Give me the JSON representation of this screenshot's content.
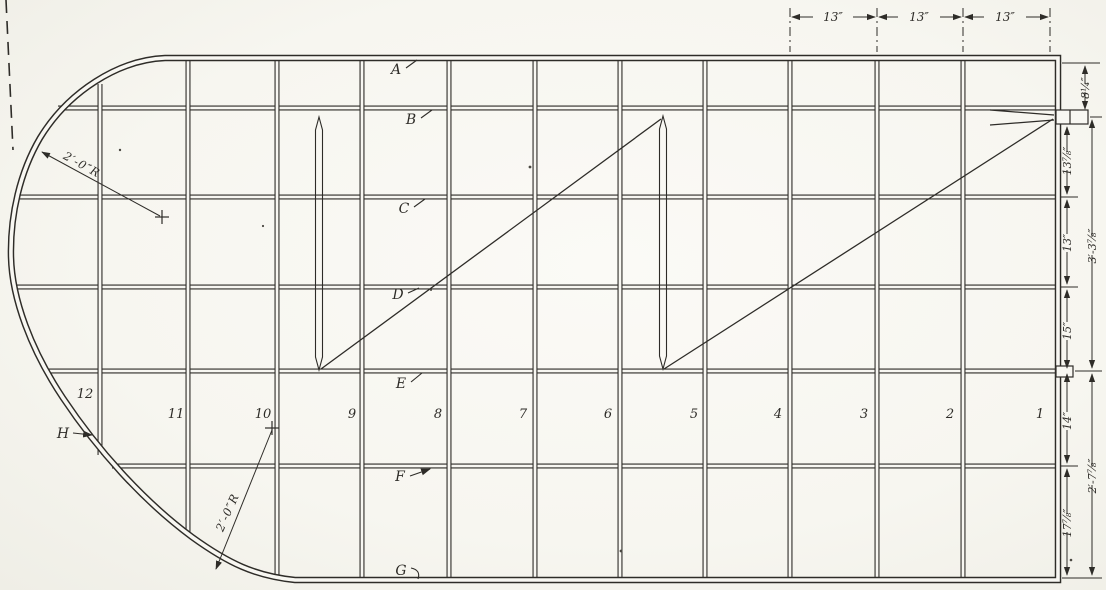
{
  "drawing": {
    "type": "wing-frame-plan-scan",
    "ink_color": "#2e2c28",
    "paper_color": "#f8f7f2",
    "rib_numbers": [
      {
        "label": "12"
      },
      {
        "label": "11"
      },
      {
        "label": "10"
      },
      {
        "label": "9"
      },
      {
        "label": "8"
      },
      {
        "label": "7"
      },
      {
        "label": "6"
      },
      {
        "label": "5"
      },
      {
        "label": "4"
      },
      {
        "label": "3"
      },
      {
        "label": "2"
      },
      {
        "label": "1"
      }
    ],
    "member_letters": [
      {
        "label": "A"
      },
      {
        "label": "B"
      },
      {
        "label": "C"
      },
      {
        "label": "D"
      },
      {
        "label": "E"
      },
      {
        "label": "F"
      },
      {
        "label": "G"
      }
    ],
    "leading_edge_label": {
      "label": "H"
    },
    "dims_top": [
      {
        "label": "13″"
      },
      {
        "label": "13″"
      },
      {
        "label": "13″"
      }
    ],
    "dims_right_inner": [
      {
        "label": "8¼″"
      },
      {
        "label": "13⅞″"
      },
      {
        "label": "13″"
      },
      {
        "label": "15″"
      },
      {
        "label": "14″"
      },
      {
        "label": "17⅞″"
      }
    ],
    "dims_right_outer": [
      {
        "label": "3′-3⅞″"
      },
      {
        "label": "2′-7⅞″"
      }
    ],
    "radius_callouts": [
      {
        "label": "2′-0″R"
      },
      {
        "label": "2′-0″R"
      }
    ]
  }
}
